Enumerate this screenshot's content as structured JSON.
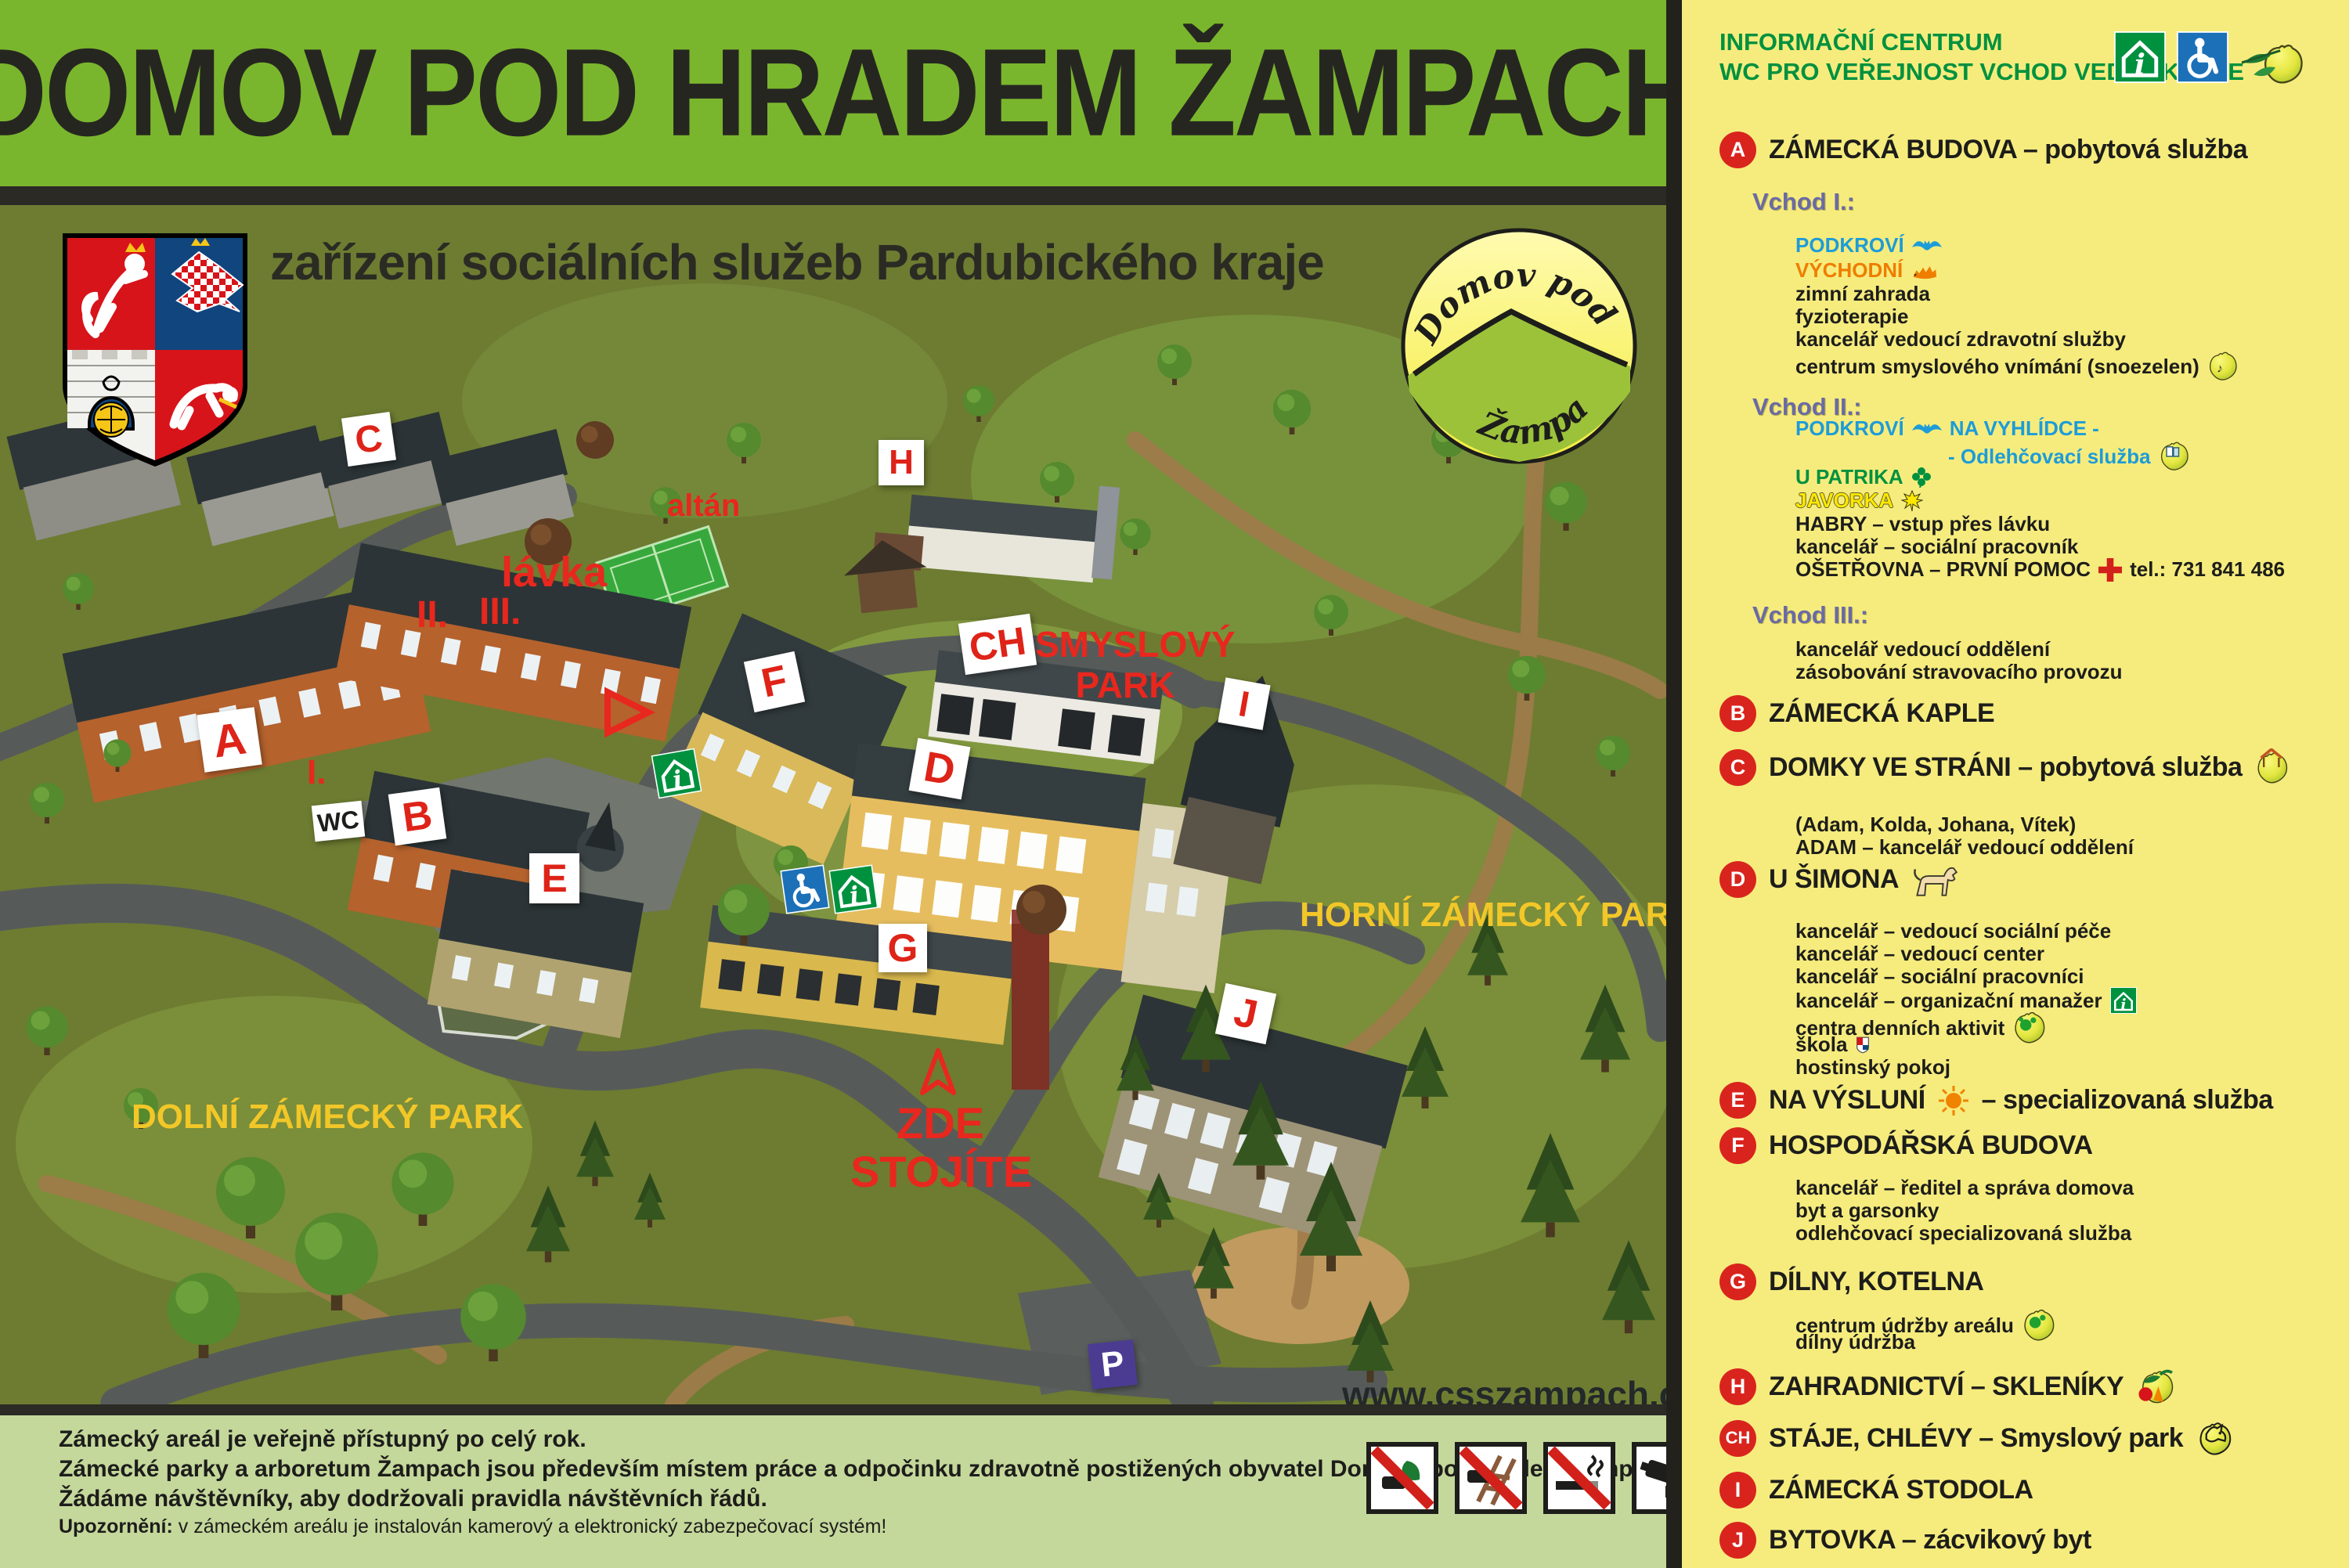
{
  "title": "DOMOV POD HRADEM ŽAMPACH",
  "subtitle": "zařízení sociálních služeb Pardubického kraje",
  "logo": {
    "top": "Domov pod hradem",
    "bottom": "Žampach"
  },
  "colors": {
    "title_bar": "#7ab62d",
    "panel_bg": "#f6ec7d",
    "footer_bg": "#c5d89b",
    "map_bg": "#6d7c31",
    "accent_red": "#de2318",
    "legend_green": "#00913f",
    "legend_blue": "#1d9cd8",
    "legend_orange": "#ef7d00",
    "legend_purple": "#6a6aa6",
    "label_yellow": "#f2c728",
    "badge_red": "#d9241e",
    "parking_purple": "#4b3c92"
  },
  "panel": {
    "h1": "INFORMAČNÍ CENTRUM",
    "h2": "WC PRO VEŘEJNOST VCHOD VEDLE KAPLE"
  },
  "legend": {
    "a_letter": "A",
    "a_title": "ZÁMECKÁ BUDOVA – pobytová služba",
    "vchod1": "Vchod I.:",
    "v1_podkrovi": "PODKROVÍ",
    "v1_vychodni": "VÝCHODNÍ",
    "v1_l1": "zimní zahrada",
    "v1_l2": "fyzioterapie",
    "v1_l3": "kancelář vedoucí zdravotní služby",
    "v1_l4": "centrum smyslového vnímání (snoezelen)",
    "vchod2": "Vchod II.:",
    "v2_podkrovi": "PODKROVÍ",
    "v2_navyhlidce": "NA VYHLÍDCE -",
    "v2_odleh": "- Odlehčovací služba",
    "v2_upatrika": "U PATRIKA",
    "v2_javorka": "JAVORKA",
    "v2_l1": "HABRY – vstup přes lávku",
    "v2_l2": "kancelář – sociální pracovník",
    "v2_osetrovna": "OŠETŘOVNA – PRVNÍ POMOC",
    "v2_tel": "tel.: 731 841 486",
    "vchod3": "Vchod III.:",
    "v3_l1": "kancelář vedoucí oddělení",
    "v3_l2": "zásobování stravovacího provozu",
    "b_letter": "B",
    "b_title": "ZÁMECKÁ KAPLE",
    "c_letter": "C",
    "c_title": "DOMKY VE STRÁNI – pobytová služba",
    "c_l1": "(Adam, Kolda, Johana, Vítek)",
    "c_l2": "ADAM – kancelář vedoucí oddělení",
    "d_letter": "D",
    "d_title": "U ŠIMONA",
    "d_l1": "kancelář – vedoucí sociální péče",
    "d_l2": "kancelář – vedoucí center",
    "d_l3": "kancelář – sociální pracovníci",
    "d_l4": "kancelář – organizační manažer",
    "d_l5": "centra denních aktivit",
    "d_l6": "škola",
    "d_l7": "hostinský pokoj",
    "e_letter": "E",
    "e_t1": "NA VÝSLUNÍ",
    "e_t2": "– specializovaná služba",
    "f_letter": "F",
    "f_title": "HOSPODÁŘSKÁ BUDOVA",
    "f_l1": "kancelář – ředitel a správa domova",
    "f_l2": "byt a garsonky",
    "f_l3": "odlehčovací specializovaná služba",
    "g_letter": "G",
    "g_title": "DÍLNY, KOTELNA",
    "g_l1": "centrum údržby areálu",
    "g_l2": "dílny údržba",
    "h_letter": "H",
    "h_title": "ZAHRADNICTVÍ – SKLENÍKY",
    "ch_letter": "CH",
    "ch_title": "STÁJE, CHLÉVY – Smyslový park",
    "i_letter": "I",
    "i_title": "ZÁMECKÁ STODOLA",
    "j_letter": "J",
    "j_title": "BYTOVKA – zácvikový byt"
  },
  "map": {
    "labels": {
      "a": "A",
      "b": "B",
      "c": "C",
      "d": "D",
      "e": "E",
      "f": "F",
      "g": "G",
      "h": "H",
      "ch": "CH",
      "i": "I",
      "j": "J",
      "p": "P",
      "wc": "WC",
      "r1": "I.",
      "r2": "II.",
      "r3": "III.",
      "lavka": "lávka",
      "altan": "altán",
      "zde1": "ZDE",
      "zde2": "STOJÍTE",
      "sm1": "SMYSLOVÝ",
      "sm2": "PARK",
      "dolni": "DOLNÍ ZÁMECKÝ PARK",
      "horni": "HORNÍ ZÁMECKÝ PARK",
      "www": "www.csszampach.cz"
    }
  },
  "footer": {
    "l1": "Zámecký areál je veřejně přístupný po celý rok.",
    "l2": "Zámecké parky a arboretum Žampach jsou především místem práce a odpočinku zdravotně postižených obyvatel Domova pod hradem Žampach.",
    "l3": "Žádáme návštěvníky, aby dodržovali pravidla návštěvních řádů.",
    "l4b": "Upozornění:",
    "l4r": "v zámeckém areálu je instalován kamerový a elektronický zabezpečovací systém!"
  }
}
